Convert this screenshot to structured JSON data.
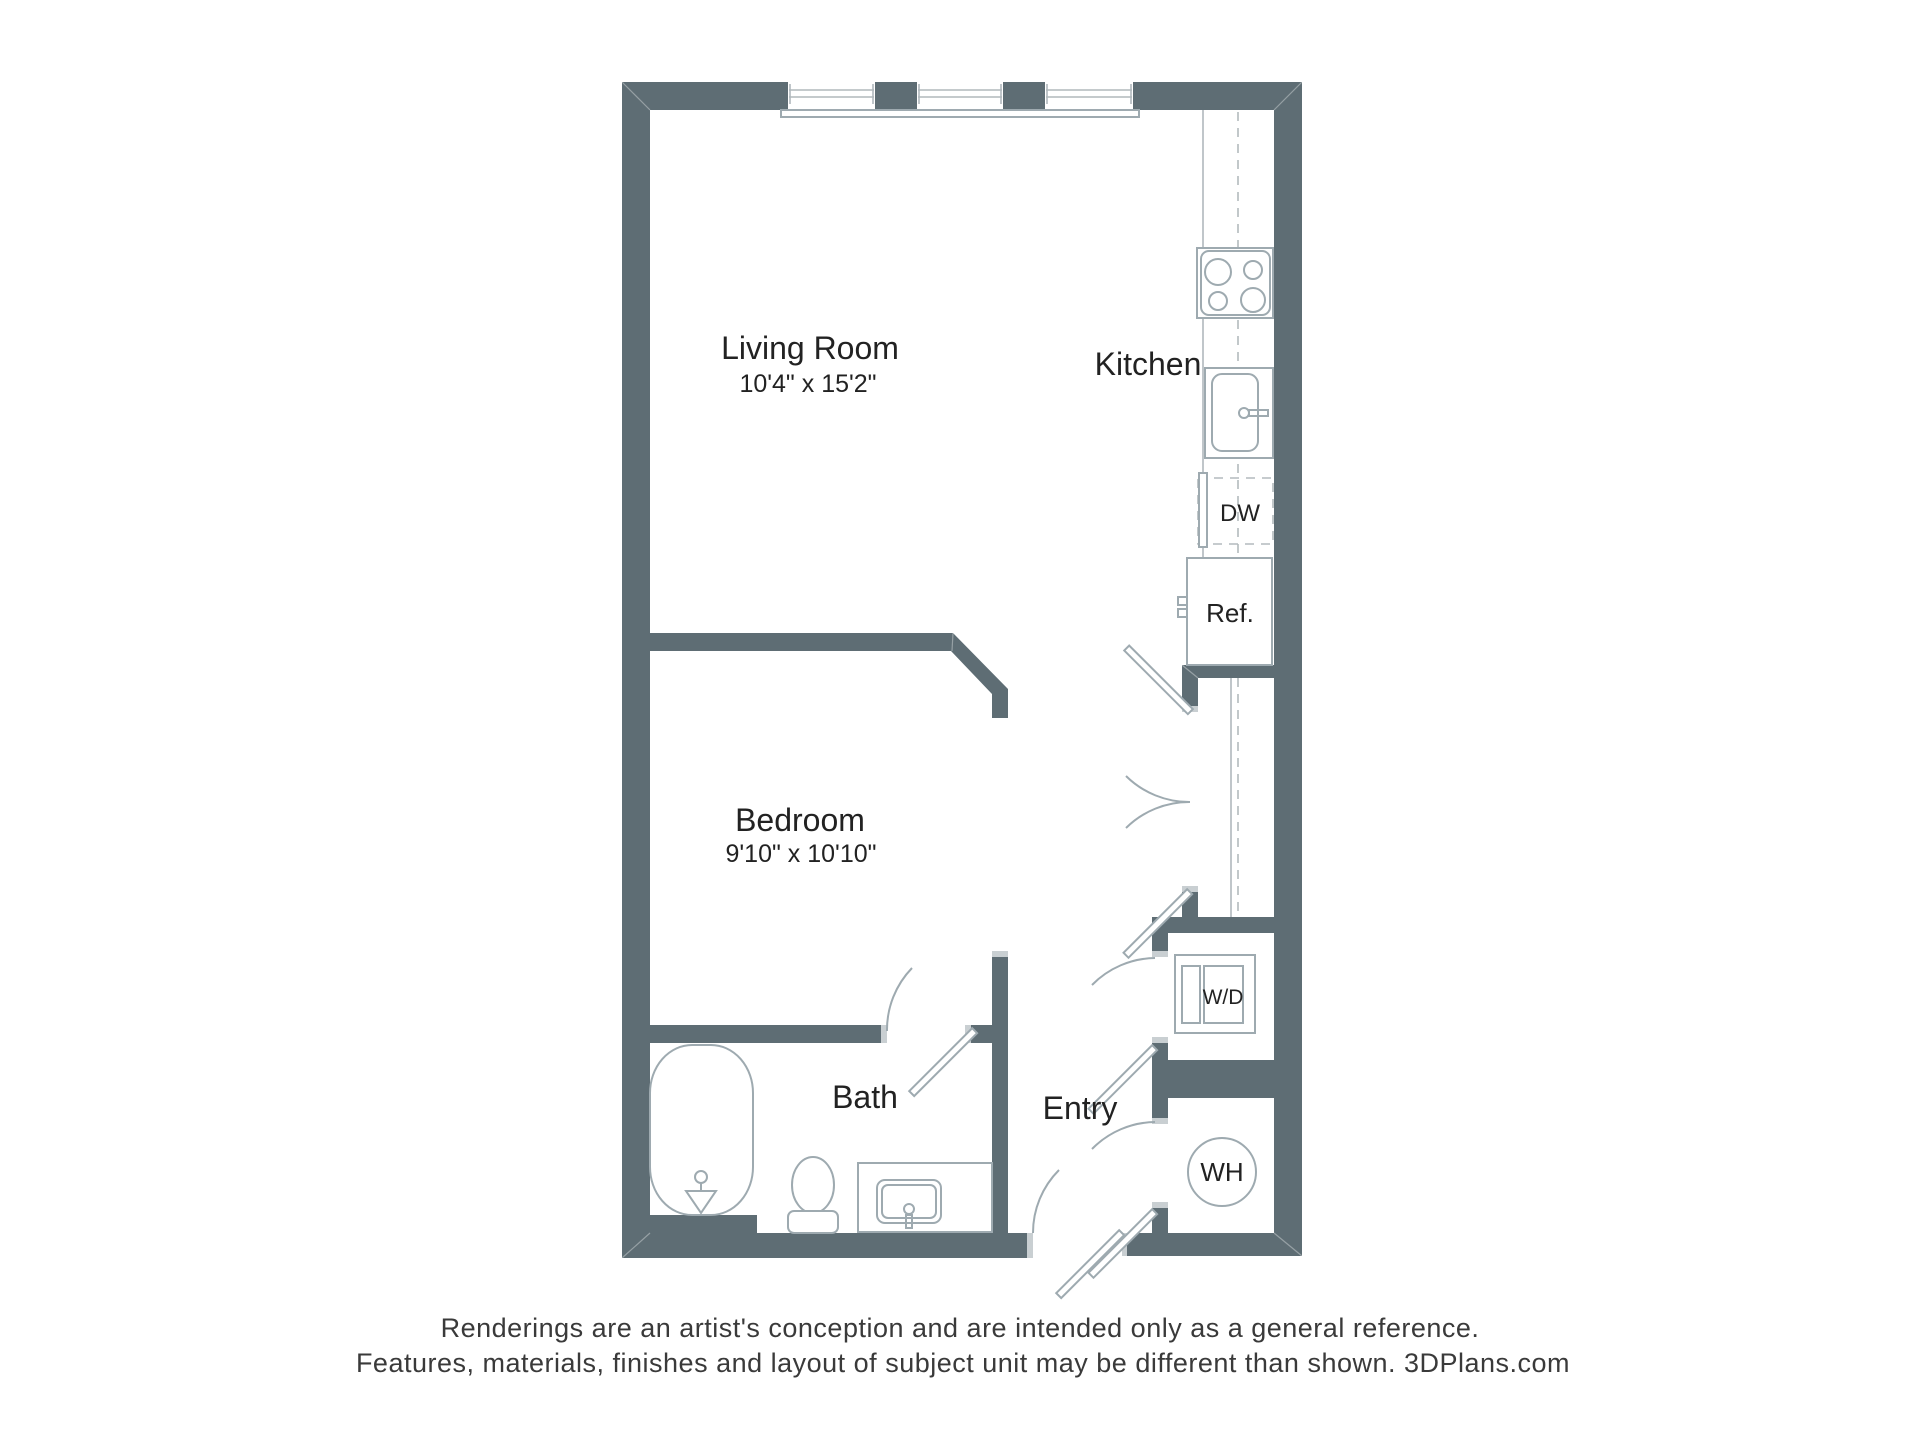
{
  "plan": {
    "rooms": {
      "living_room": {
        "label": "Living Room",
        "dims": "10'4\" x 15'2\""
      },
      "kitchen": {
        "label": "Kitchen"
      },
      "bedroom": {
        "label": "Bedroom",
        "dims": "9'10\" x 10'10\""
      },
      "bath": {
        "label": "Bath"
      },
      "entry": {
        "label": "Entry"
      }
    },
    "fixtures": {
      "dishwasher": "DW",
      "refrigerator": "Ref.",
      "washer_dryer": "W/D",
      "water_heater": "WH"
    },
    "colors": {
      "wall": "#5e6d74",
      "fixture_line": "#9eaab0",
      "text": "#222222",
      "footer_text": "#3a3a3a"
    }
  },
  "footer": {
    "line1": "Renderings are an artist's conception and are intended only as a general reference.",
    "line2": "Features, materials, finishes and layout of subject unit may be different than shown. 3DPlans.com"
  }
}
